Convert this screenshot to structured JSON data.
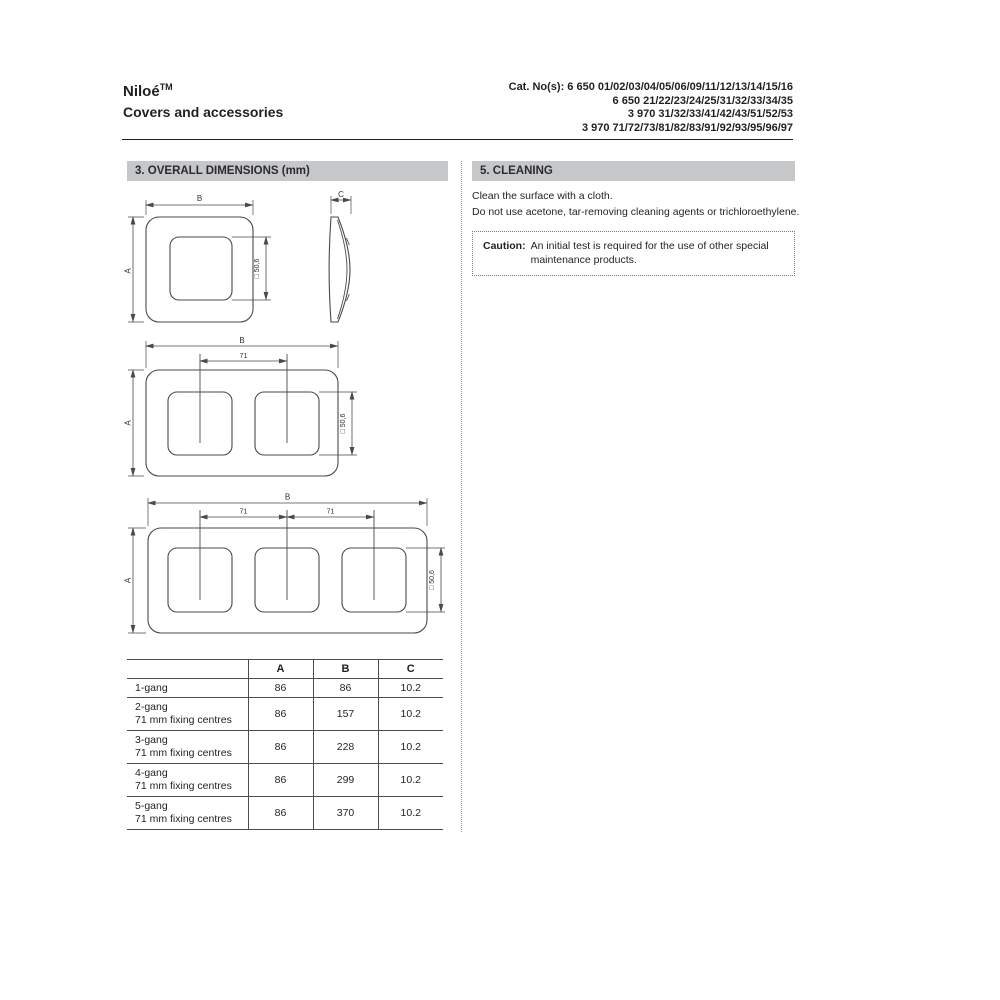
{
  "header": {
    "title": "Niloé",
    "trademark": "TM",
    "subtitle": "Covers and accessories",
    "cat_lines": [
      "Cat. No(s): 6 650 01/02/03/04/05/06/09/11/12/13/14/15/16",
      "6 650 21/22/23/24/25/31/32/33/34/35",
      "3 970 31/32/33/41/42/43/51/52/53",
      "3 970 71/72/73/81/82/83/91/92/93/95/96/97"
    ]
  },
  "dimensions": {
    "heading": "3. OVERALL DIMENSIONS (mm)",
    "labels": {
      "width": "B",
      "height": "A",
      "depth": "C",
      "window": "□ 50,6",
      "fixing": "71"
    },
    "table": {
      "col_headers": [
        "",
        "A",
        "B",
        "C"
      ],
      "rows": [
        {
          "name": "1-gang",
          "sub": "",
          "A": "86",
          "B": "86",
          "C": "10.2"
        },
        {
          "name": "2-gang",
          "sub": "71 mm fixing centres",
          "A": "86",
          "B": "157",
          "C": "10.2"
        },
        {
          "name": "3-gang",
          "sub": "71 mm fixing centres",
          "A": "86",
          "B": "228",
          "C": "10.2"
        },
        {
          "name": "4-gang",
          "sub": "71 mm fixing centres",
          "A": "86",
          "B": "299",
          "C": "10.2"
        },
        {
          "name": "5-gang",
          "sub": "71 mm fixing centres",
          "A": "86",
          "B": "370",
          "C": "10.2"
        }
      ]
    }
  },
  "cleaning": {
    "heading": "5. CLEANING",
    "lines": [
      "Clean the surface with a cloth.",
      "Do not use acetone, tar-removing cleaning agents or trichloroethylene."
    ],
    "caution_label": "Caution:",
    "caution_lines": [
      "An initial test is required for the use of other special",
      "maintenance products."
    ]
  },
  "colors": {
    "section_bar_bg": "#c6c7c9",
    "text": "#231f20"
  }
}
